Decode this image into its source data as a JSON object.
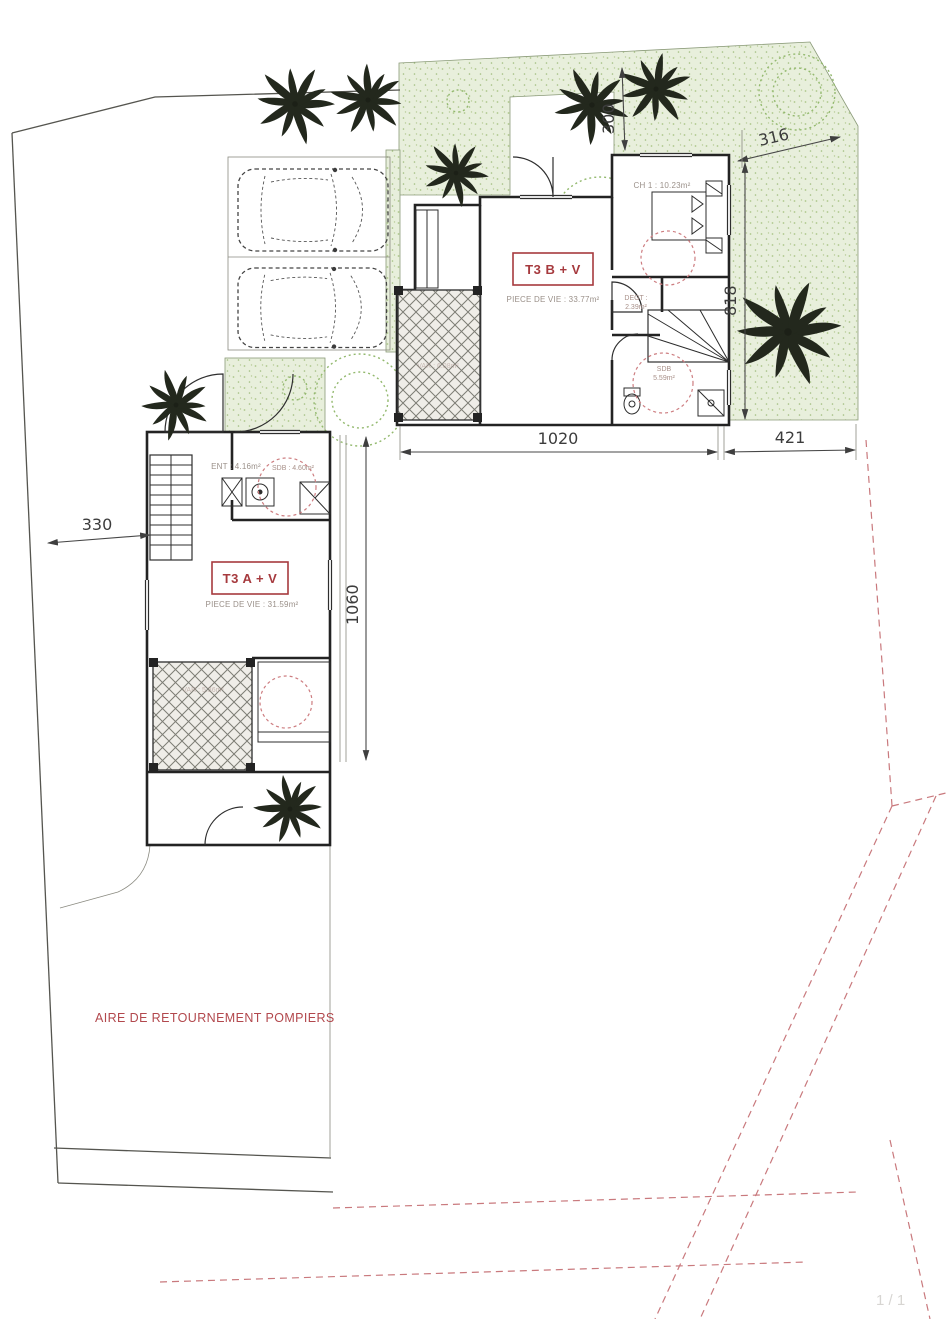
{
  "plan": {
    "unit_b": {
      "label": "T3 B + V",
      "living_room": "PIECE DE VIE : 33.77m²",
      "bedroom": "CH 1 : 10.23m²",
      "degagement_name": "DEGT :",
      "degagement_area": "2.39m²",
      "bathroom_name": "SDB",
      "bathroom_area": "5.59m²",
      "varangue": "VAR : 6.08m²"
    },
    "unit_a": {
      "label": "T3 A + V",
      "living_room": "PIECE DE VIE : 31.59m²",
      "entrance": "ENT : 4.16m²",
      "bathroom": "SDB : 4.60m²",
      "varangue": "VAR : 5.36m²"
    },
    "dimensions": {
      "garden_top_depth": "300",
      "garden_top_width": "316",
      "garden_right_depth": "818",
      "building_b_width": "1020",
      "garden_right_width": "421",
      "left_setback": "330",
      "building_a_depth": "1060"
    },
    "annotations": {
      "fire_turning_area": "AIRE DE RETOURNEMENT POMPIERS",
      "page_indicator": "1 / 1"
    },
    "colors": {
      "annotation_red": "#a63a3e",
      "dashed_red": "#c9797d",
      "green_fill": "#e8efdc",
      "tree_green": "#93b96e",
      "line_dark": "#3c3c3c"
    }
  }
}
